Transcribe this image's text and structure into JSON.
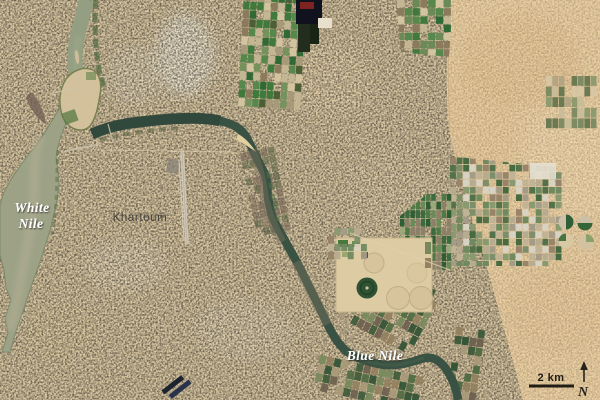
{
  "labels": {
    "white_nile_line1": "White",
    "white_nile_line2": "Nile",
    "city": "Khartoum",
    "blue_nile": "Blue Nile"
  },
  "scale_bar": {
    "label": "2 km"
  },
  "north_arrow": {
    "label": "N"
  },
  "features": {
    "left_river": "White Nile",
    "right_river": "Blue Nile",
    "island": "river island at confluence",
    "city_area": "Khartoum urban fabric",
    "desert_area": "desert (east)",
    "fields": "irrigated field grids",
    "pivot_circles": "center-pivot irrigation circles",
    "runway": "airport runway"
  },
  "colors": {
    "city_tan": "#d9c7a2",
    "desert": "#ecd0a2",
    "white_nile_water": "#9da287",
    "combined_nile_water": "#939e82",
    "blue_nile_water": "#3a5243",
    "label_white": "#ffffff",
    "label_dark": "#44403a",
    "scalebar_black": "#211d16",
    "palettes": {
      "fieldsA": [
        "#2f6a35",
        "#55884a",
        "#76925c",
        "#c3b692",
        "#8b7a5c",
        "#3f7a3c",
        "#a79a79",
        "#d2c49e",
        "#4c5e35"
      ],
      "fieldsB": [
        "#6f8a5f",
        "#a59c88",
        "#8a9a70",
        "#c0b396",
        "#54724a",
        "#97846a",
        "#d8d2c2",
        "#7d8f6a",
        "#b7ab90",
        "#476b40"
      ],
      "fieldsC": [
        "#3b6b3f",
        "#2f5e33",
        "#6b8a58",
        "#8d8068",
        "#4e7a45",
        "#9aa87c"
      ],
      "fieldsD": [
        "#2f6a35",
        "#55884a",
        "#8b7a5c",
        "#c3b692",
        "#3f7a3c",
        "#6b8a58",
        "#d2c49e"
      ],
      "muted": [
        "#7f8b63",
        "#b3a584",
        "#8f9a6e",
        "#c9bc98",
        "#6b7a52",
        "#d6c7a2"
      ],
      "riverside": [
        "#4e6b42",
        "#77895c",
        "#93805f",
        "#3c5a38",
        "#a99a79",
        "#6d5f4e",
        "#2f5233"
      ],
      "darkbank": [
        "#6f6054",
        "#7c6a58",
        "#5d6647",
        "#86755f",
        "#4f5a40",
        "#715f50"
      ]
    }
  }
}
